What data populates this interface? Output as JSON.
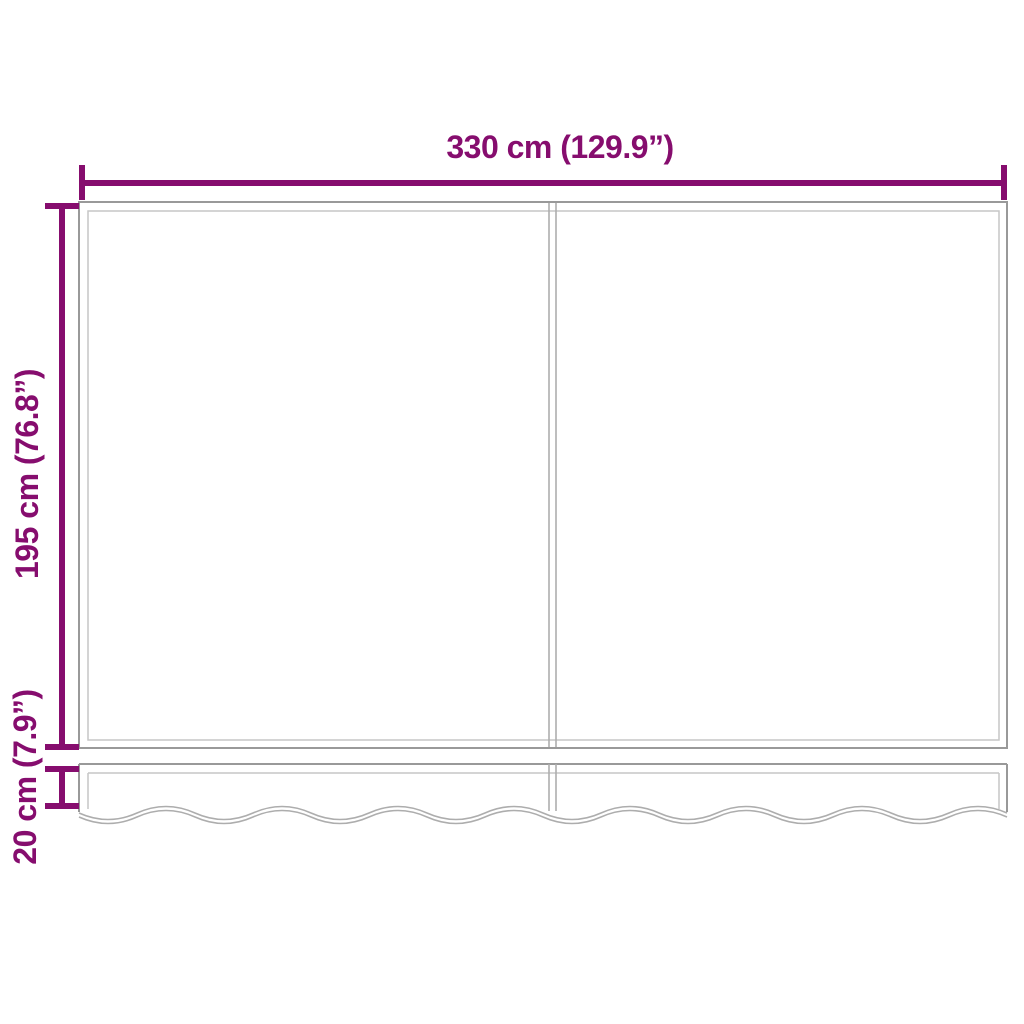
{
  "colors": {
    "accent": "#860D6E",
    "outline_strong": "#999999",
    "outline_mid": "#ADADAD",
    "outline_light": "#C6C6C6",
    "background": "#FFFFFF"
  },
  "labels": {
    "width": "330 cm (129.9”)",
    "height": "195 cm (76.8”)",
    "valance_height": "20 cm (7.9”)"
  }
}
